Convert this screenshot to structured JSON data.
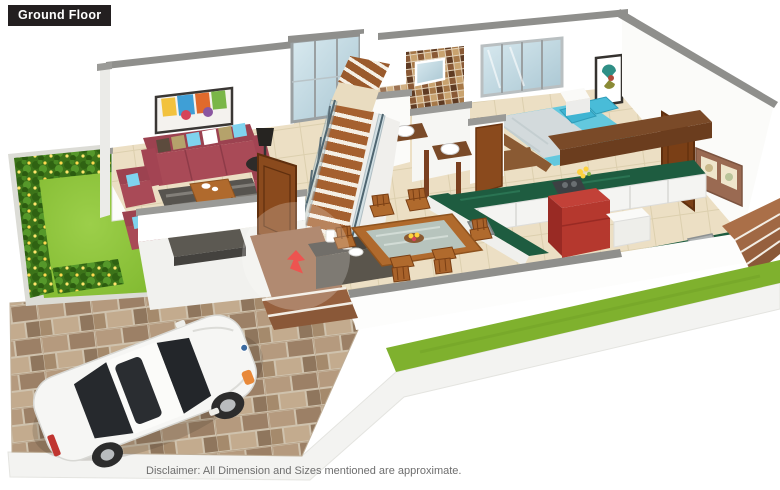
{
  "page": {
    "title": "Ground Floor",
    "disclaimer": "Disclaimer: All Dimension and Sizes mentioned are approximate."
  },
  "floorplan": {
    "view": "3d-isometric-ground-floor-plan",
    "elements": [
      "garden-lawn",
      "flower-hedge",
      "paved-driveway",
      "white-car",
      "entrance-porch",
      "entry-arrow",
      "living-room-sofa-set",
      "coffee-table",
      "rug",
      "tv-unit",
      "floor-lamp",
      "wall-painting",
      "main-door",
      "staircase",
      "glass-railing",
      "stair-window",
      "bathroom",
      "wash-basins",
      "mosaic-tile-wall",
      "bedroom-double-bed",
      "bedroom-window",
      "picture-frame",
      "study-desk",
      "kitchen-l-counter",
      "gas-hob",
      "kitchen-sink",
      "refrigerator",
      "utility-counter",
      "kitchen-door",
      "wall-shelf",
      "dining-table-six-chairs",
      "sideboard",
      "side-steps",
      "front-lawn-strip"
    ],
    "palette": {
      "label_bg": "#231f20",
      "label_text": "#ffffff",
      "disclaimer_text": "#6e6e6e",
      "wall_white": "#ffffff",
      "wall_cap_gray": "#8f8f8c",
      "floor_tile": "#ecdfc4",
      "lawn_green": "#8cc63e",
      "hedge_green": "#3f7d1c",
      "hedge_flowers": "#ffd94f",
      "paver_brown": "#a98f72",
      "porch_brown": "#9c6a49",
      "stair_wood": "#a5602f",
      "sofa_red": "#a94a57",
      "cushion_blue": "#7fd3ee",
      "bed_cyan": "#63c8de",
      "kitchen_counter_green": "#1e5c40",
      "refrigerator_red": "#b5382e",
      "wood_door": "#8a4a1d",
      "dining_wood": "#b06a2d",
      "glass_blue": "#c2dbe3",
      "car_white": "#f6f6f4",
      "entry_arrow_red": "#e8251f"
    }
  }
}
